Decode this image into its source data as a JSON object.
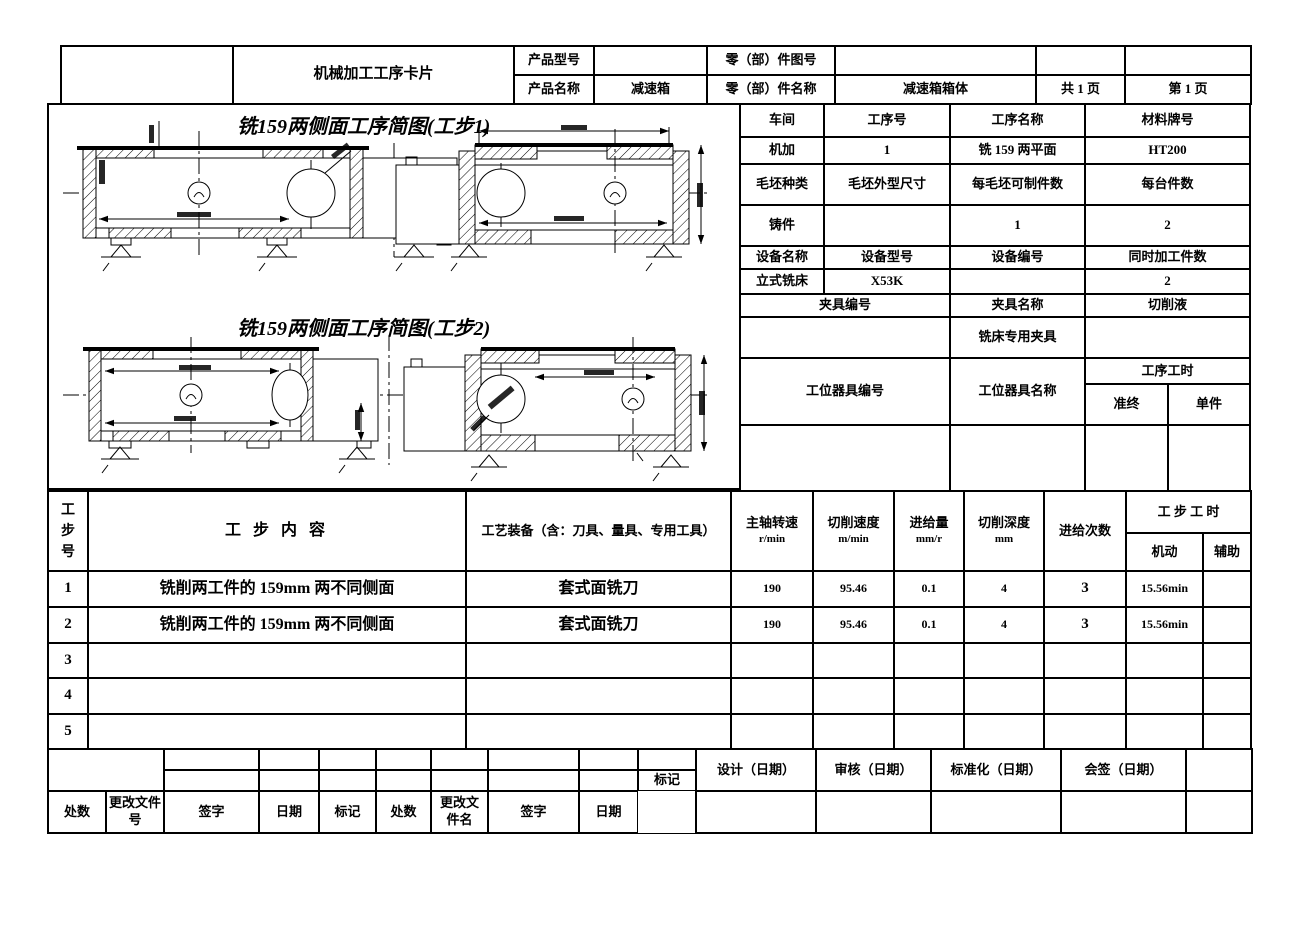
{
  "header": {
    "doc_title": "机械加工工序卡片",
    "product_model_label": "产品型号",
    "product_model_value": "",
    "product_name_label": "产品名称",
    "product_name_value": "减速箱",
    "part_no_label": "零（部）件图号",
    "part_no_value": "",
    "part_name_label": "零（部）件名称",
    "part_name_value": "减速箱箱体",
    "pages_total": "共 1 页",
    "page_current": "第 1 页"
  },
  "sketches": {
    "step1_title": "铣159两侧面工序简图(工步1)",
    "step2_title": "铣159两侧面工序简图(工步2)"
  },
  "process_info": {
    "row1_labels": [
      "车间",
      "工序号",
      "工序名称",
      "材料牌号"
    ],
    "row1_values": [
      "机加",
      "1",
      "铣 159 两平面",
      "HT200"
    ],
    "row2_labels": [
      "毛坯种类",
      "毛坯外型尺寸",
      "每毛坯可制件数",
      "每台件数"
    ],
    "row2_values": [
      "铸件",
      "",
      "1",
      "2"
    ],
    "row3_labels": [
      "设备名称",
      "设备型号",
      "设备编号",
      "同时加工件数"
    ],
    "row3_values": [
      "立式铣床",
      "X53K",
      "",
      "2"
    ],
    "fixture_no_label": "夹具编号",
    "fixture_name_label": "夹具名称",
    "coolant_label": "切削液",
    "fixture_name_value": "铣床专用夹具",
    "station_tool_no_label": "工位器具编号",
    "station_tool_name_label": "工位器具名称",
    "process_hours_label": "工序工时",
    "prep_end_label": "准终",
    "per_piece_label": "单件"
  },
  "steps": {
    "headers": {
      "step_no": "工\n步\n号",
      "content": "工 步 内 容",
      "equipment": "工艺装备（含：刀具、量具、专用工具）",
      "spindle_label": "主轴转速",
      "spindle_unit": "r/min",
      "speed_label": "切削速度",
      "speed_unit": "m/min",
      "feed_label": "进给量",
      "feed_unit": "mm/r",
      "depth_label": "切削深度",
      "depth_unit": "mm",
      "passes_label": "进给次数",
      "time_label": "工 步 工 时",
      "machine_label": "机动",
      "aux_label": "辅助"
    },
    "rows": [
      {
        "no": "1",
        "content": "铣削两工件的 159mm 两不同侧面",
        "equipment": "套式面铣刀",
        "spindle": "190",
        "speed": "95.46",
        "feed": "0.1",
        "depth": "4",
        "passes": "3",
        "machine": "15.56min",
        "aux": ""
      },
      {
        "no": "2",
        "content": "铣削两工件的 159mm 两不同侧面",
        "equipment": "套式面铣刀",
        "spindle": "190",
        "speed": "95.46",
        "feed": "0.1",
        "depth": "4",
        "passes": "3",
        "machine": "15.56min",
        "aux": ""
      },
      {
        "no": "3",
        "content": "",
        "equipment": "",
        "spindle": "",
        "speed": "",
        "feed": "",
        "depth": "",
        "passes": "",
        "machine": "",
        "aux": ""
      },
      {
        "no": "4",
        "content": "",
        "equipment": "",
        "spindle": "",
        "speed": "",
        "feed": "",
        "depth": "",
        "passes": "",
        "machine": "",
        "aux": ""
      },
      {
        "no": "5",
        "content": "",
        "equipment": "",
        "spindle": "",
        "speed": "",
        "feed": "",
        "depth": "",
        "passes": "",
        "machine": "",
        "aux": ""
      }
    ]
  },
  "approval": {
    "design_label": "设计（日期）",
    "check_label": "审核（日期）",
    "standard_label": "标准化（日期）",
    "countersign_label": "会签（日期）"
  },
  "revision": {
    "labels": [
      "标记",
      "处数",
      "更改文件号",
      "签字",
      "日期",
      "标记",
      "处数",
      "更改文件名",
      "签字",
      "日期"
    ]
  }
}
